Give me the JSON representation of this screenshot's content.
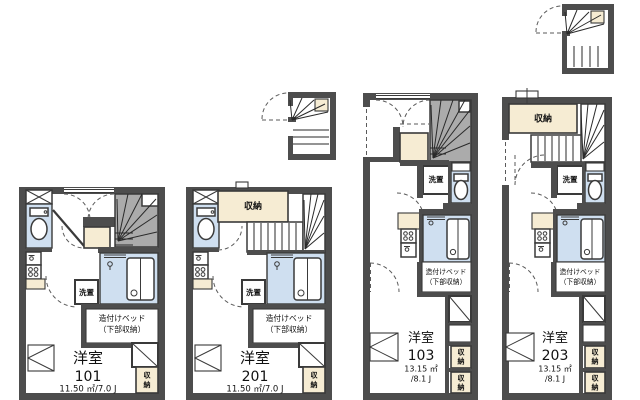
{
  "floorplan": {
    "labels": {
      "bed_line1": "造付けベッド",
      "bed_line2": "（下部収納）",
      "laundry": "洗置",
      "storage": "収納",
      "storage_char_top": "収",
      "storage_char_bottom": "納"
    },
    "units": [
      {
        "number": "101",
        "room_type": "洋室",
        "area_line1": "11.50 ㎡/7.0 J"
      },
      {
        "number": "201",
        "room_type": "洋室",
        "area_line1": "11.50 ㎡/7.0 J"
      },
      {
        "number": "103",
        "room_type": "洋室",
        "area_line1": "13.15 ㎡",
        "area_line2": "/8.1 J"
      },
      {
        "number": "203",
        "room_type": "洋室",
        "area_line1": "13.15 ㎡",
        "area_line2": "/8.1 J"
      }
    ],
    "colors": {
      "wall": "#4d4d4d",
      "water_room": "#cfdff0",
      "storage_beige": "#f6ecd3",
      "stair_gray": "#ababab",
      "background": "#ffffff"
    }
  }
}
